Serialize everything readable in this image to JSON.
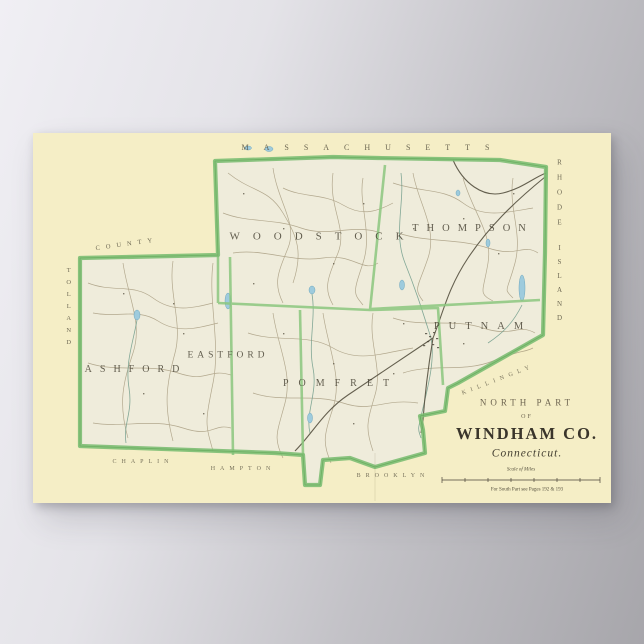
{
  "poster": {
    "region_labels": {
      "north": "MASSACHUSETTS",
      "east_line1": "RHODE",
      "east_line2": "ISLAND",
      "west_vertical": "TOLLAND",
      "west_diagonal": "COUNTY",
      "south": [
        "CHAPLIN",
        "HAMPTON",
        "BROOKLYN"
      ],
      "southeast": "KILLINGLY"
    },
    "towns": [
      "WOODSTOCK",
      "THOMPSON",
      "PUTNAM",
      "EASTFORD",
      "ASHFORD",
      "POMFRET"
    ],
    "title_block": {
      "part": "NORTH PART",
      "of": "OF",
      "county": "WINDHAM CO.",
      "state": "Connecticut.",
      "scale_caption": "Scale of Miles",
      "footnote": "For South Part see Pages 192 & 193"
    },
    "colors": {
      "paper": "#f5eec6",
      "county_interior": "#efecdb",
      "border_green": "#7dbe73",
      "water_blue": "#9ecbdd",
      "background_light": "#f0eff4",
      "background_dark": "#a7a6ab"
    }
  }
}
